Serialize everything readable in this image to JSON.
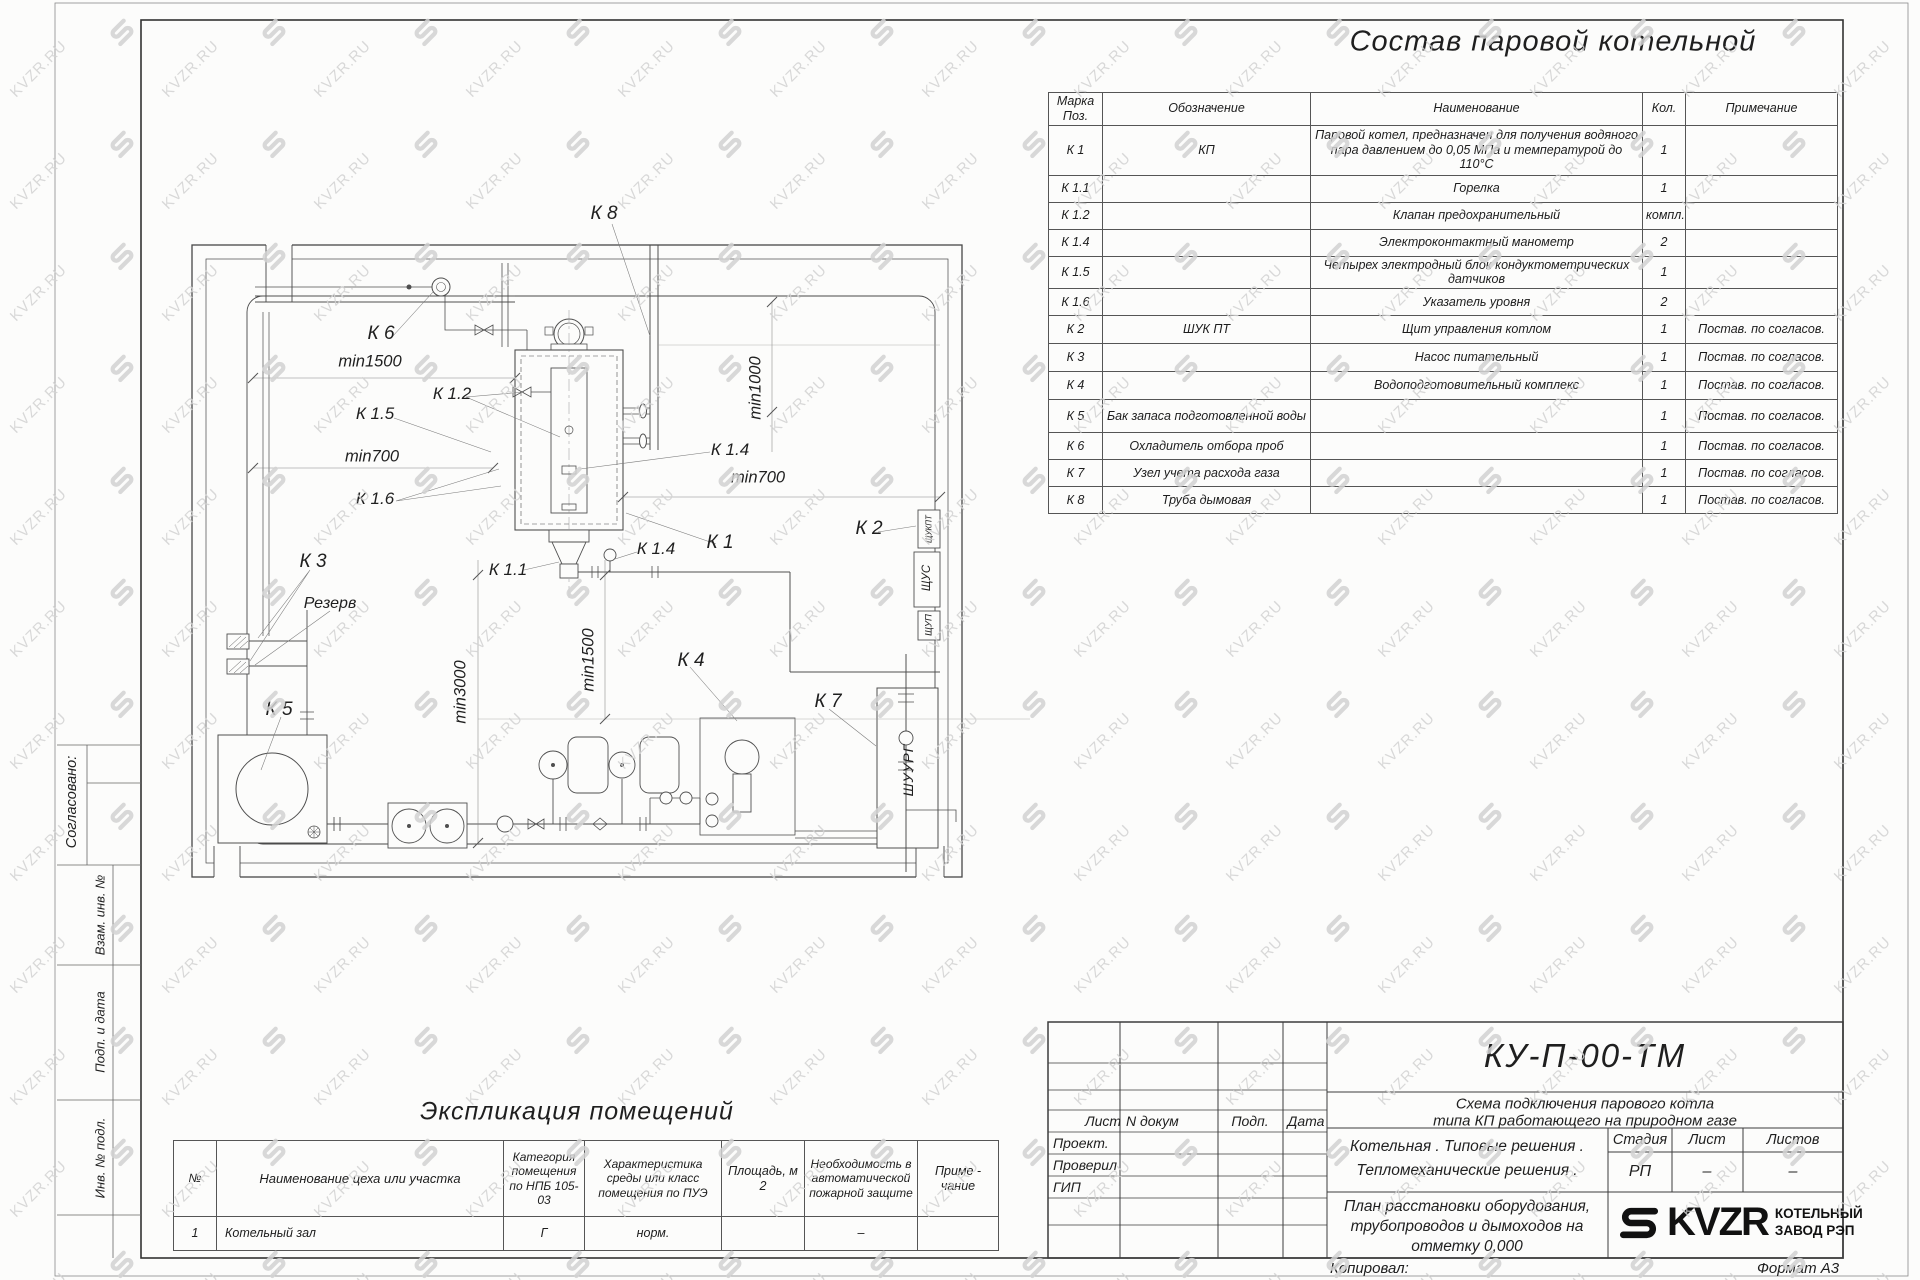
{
  "title_main": "Состав паровой котельной",
  "equipment_table": {
    "headers": [
      "Марка Поз.",
      "Обозначение",
      "Наименование",
      "Кол.",
      "Примечание"
    ],
    "rows": [
      {
        "mark": "К 1",
        "designation": "КП",
        "name": "Паровой котел, предназначен для получения водяного пара давлением до 0,05 МПа и температурой до 110°С",
        "qty": "1",
        "note": ""
      },
      {
        "mark": "К 1.1",
        "designation": "",
        "name": "Горелка",
        "qty": "1",
        "note": ""
      },
      {
        "mark": "К 1.2",
        "designation": "",
        "name": "Клапан предохранительный",
        "qty": "компл.",
        "note": ""
      },
      {
        "mark": "К 1.4",
        "designation": "",
        "name": "Электроконтактный манометр",
        "qty": "2",
        "note": ""
      },
      {
        "mark": "К 1.5",
        "designation": "",
        "name": "Четырех электродный блок кондуктометрических датчиков",
        "qty": "1",
        "note": ""
      },
      {
        "mark": "К 1.6",
        "designation": "",
        "name": "Указатель уровня",
        "qty": "2",
        "note": ""
      },
      {
        "mark": "К 2",
        "designation": "ШУК ПТ",
        "name": "Щит управления котлом",
        "qty": "1",
        "note": "Постав. по согласов."
      },
      {
        "mark": "К 3",
        "designation": "",
        "name": "Насос питательный",
        "qty": "1",
        "note": "Постав. по согласов."
      },
      {
        "mark": "К 4",
        "designation": "",
        "name": "Водоподготовительный комплекс",
        "qty": "1",
        "note": "Постав. по согласов."
      },
      {
        "mark": "К 5",
        "designation": "Бак запаса подготовленной воды",
        "name": "",
        "qty": "1",
        "note": "Постав. по согласов."
      },
      {
        "mark": "К 6",
        "designation": "Охладитель отбора проб",
        "name": "",
        "qty": "1",
        "note": "Постав. по согласов."
      },
      {
        "mark": "К 7",
        "designation": "Узел учета расхода газа",
        "name": "",
        "qty": "1",
        "note": "Постав. по согласов."
      },
      {
        "mark": "К 8",
        "designation": "Труба дымовая",
        "name": "",
        "qty": "1",
        "note": "Постав. по согласов."
      }
    ]
  },
  "plan": {
    "labels": {
      "k8": "К 8",
      "k6": "К 6",
      "k12": "К 1.2",
      "k15": "К 1.5",
      "k16": "К 1.6",
      "k3": "К 3",
      "reserve": "Резерв",
      "k5": "К 5",
      "k11": "К 1.1",
      "k14a": "К 1.4",
      "k14b": "К 1.4",
      "k4": "К 4",
      "k7": "К 7",
      "k1": "К 1",
      "k2": "К 2"
    },
    "dims": {
      "d1500a": "min1500",
      "d700a": "min700",
      "d3000": "min3000",
      "d1500b": "min1500",
      "d1000": "min1000",
      "d700b": "min700"
    },
    "panels": {
      "p1": "ЩУКПТ",
      "p2": "ЩУС",
      "p3": "ЩУП",
      "p4": "ШУУРГ"
    }
  },
  "explication": {
    "title": "Экспликация помещений",
    "headers": [
      "№",
      "Наименование цеха или участка",
      "Категория помещения по НПБ 105-03",
      "Характеристика среды или класс помещения по ПУЭ",
      "Площадь, м 2",
      "Необходимость в автоматической пожарной защите",
      "Приме - чание"
    ],
    "rows": [
      [
        "1",
        "Котельный зал",
        "Г",
        "норм.",
        "",
        "–",
        ""
      ]
    ]
  },
  "sidebar": {
    "items": [
      "Согласовано:",
      "Взам. инв. №",
      "Подп. и дата",
      "Инв. № подл."
    ]
  },
  "title_block": {
    "doc_number": "КУ-П-00-ТМ",
    "subtitle1": "Схема подключения парового котла",
    "subtitle2": "типа КП работающего на природном газе",
    "cols": [
      "Лист",
      "N докум",
      "Подп.",
      "Дата"
    ],
    "roles": [
      "Проект.",
      "Проверил",
      "ГИП"
    ],
    "desc1": "Котельная . Типовые решения .",
    "desc2": "Тепломеханические решения .",
    "sheet1": "План расстановки оборудования,",
    "sheet2": "трубопроводов и дымоходов на",
    "sheet3": "отметку 0,000",
    "stage_headers": [
      "Стадия",
      "Лист",
      "Листов"
    ],
    "stage_values": [
      "РП",
      "–",
      "–"
    ],
    "logo": {
      "brand": "KVZR",
      "line1": "КОТЕЛЬНЫЙ",
      "line2": "ЗАВОД РЭП"
    },
    "copied": "Копировал:",
    "format": "Формат А3"
  },
  "watermark": {
    "text": "KVZR.RU"
  }
}
